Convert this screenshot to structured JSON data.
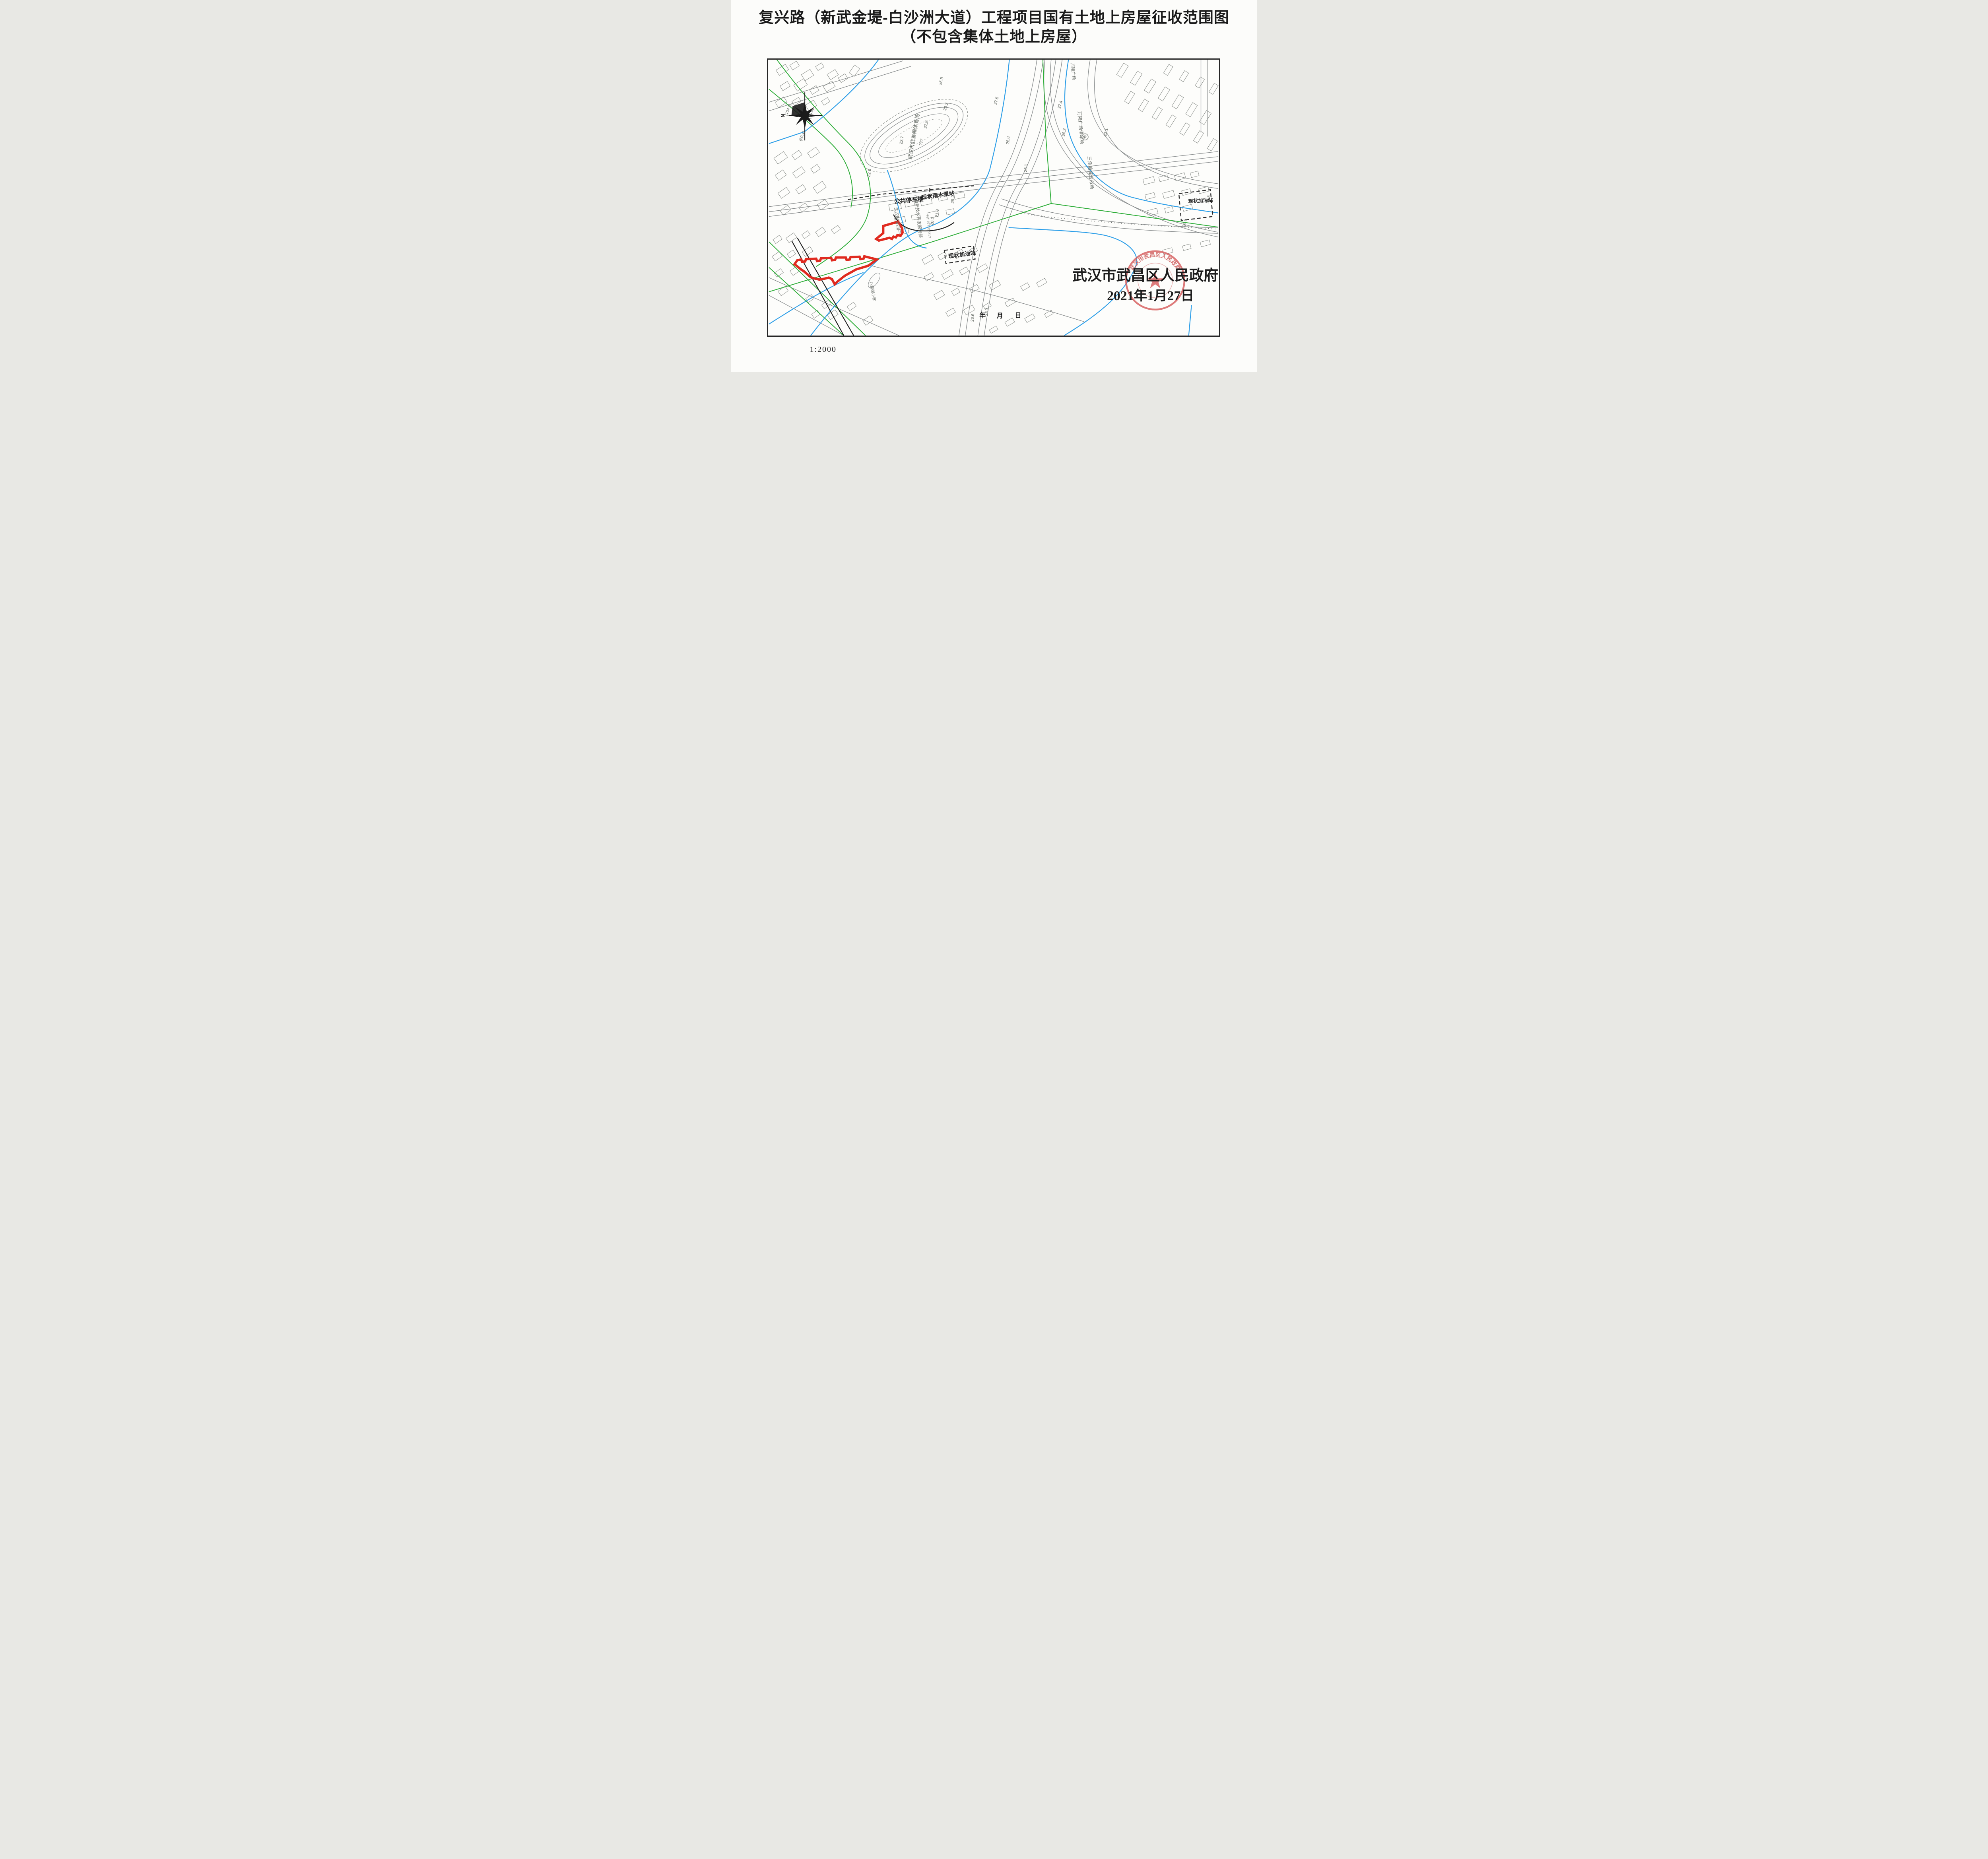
{
  "page": {
    "title_line1": "复兴路（新武金堤-白沙洲大道）工程项目国有土地上房屋征收范围图",
    "title_line2": "（不包含集体土地上房屋）",
    "scale_label": "1:2000"
  },
  "map": {
    "north_label": "N",
    "authority": {
      "name": "武汉市武昌区人民政府",
      "date": "2021年1月27日"
    },
    "seal": {
      "arc_text": "武汉市武昌区人民政府"
    },
    "date_placeholder": {
      "year": "年",
      "month": "月",
      "day": "日"
    },
    "labels": {
      "parking_tower": "公共停车楼",
      "rain_pump_station": "现状雨水泵站",
      "gas_station_left": "现状加油站",
      "gas_station_right": "现状加油站",
      "stadium": "武汉市武泰闸体育场",
      "stadium_sub": "???",
      "wanlong_plaza": "万隆广场",
      "wanlong_parking": "万隆广场停车场",
      "sanjiaotang_market": "三角塘综合市场",
      "tech_service": "市政新技术开发服务部",
      "paint_factory": "武汉制漆四厂",
      "primary_school": "八铺街小学",
      "parking_symbol": "P",
      "survey_note": "?2019?10?21?"
    },
    "annotations": {
      "a0": "(104.2)",
      "a1": "(45.4)",
      "a2": "(60.4)"
    },
    "elevations": [
      "22.7",
      "22.8",
      "22.6",
      "26.9",
      "23.2",
      "26.8",
      "26.1",
      "26.3",
      "26.6",
      "27.4",
      "27.5",
      "26.2",
      "22.1",
      "29.2",
      "24.6",
      "21.3",
      "20.2",
      "21.0"
    ]
  }
}
